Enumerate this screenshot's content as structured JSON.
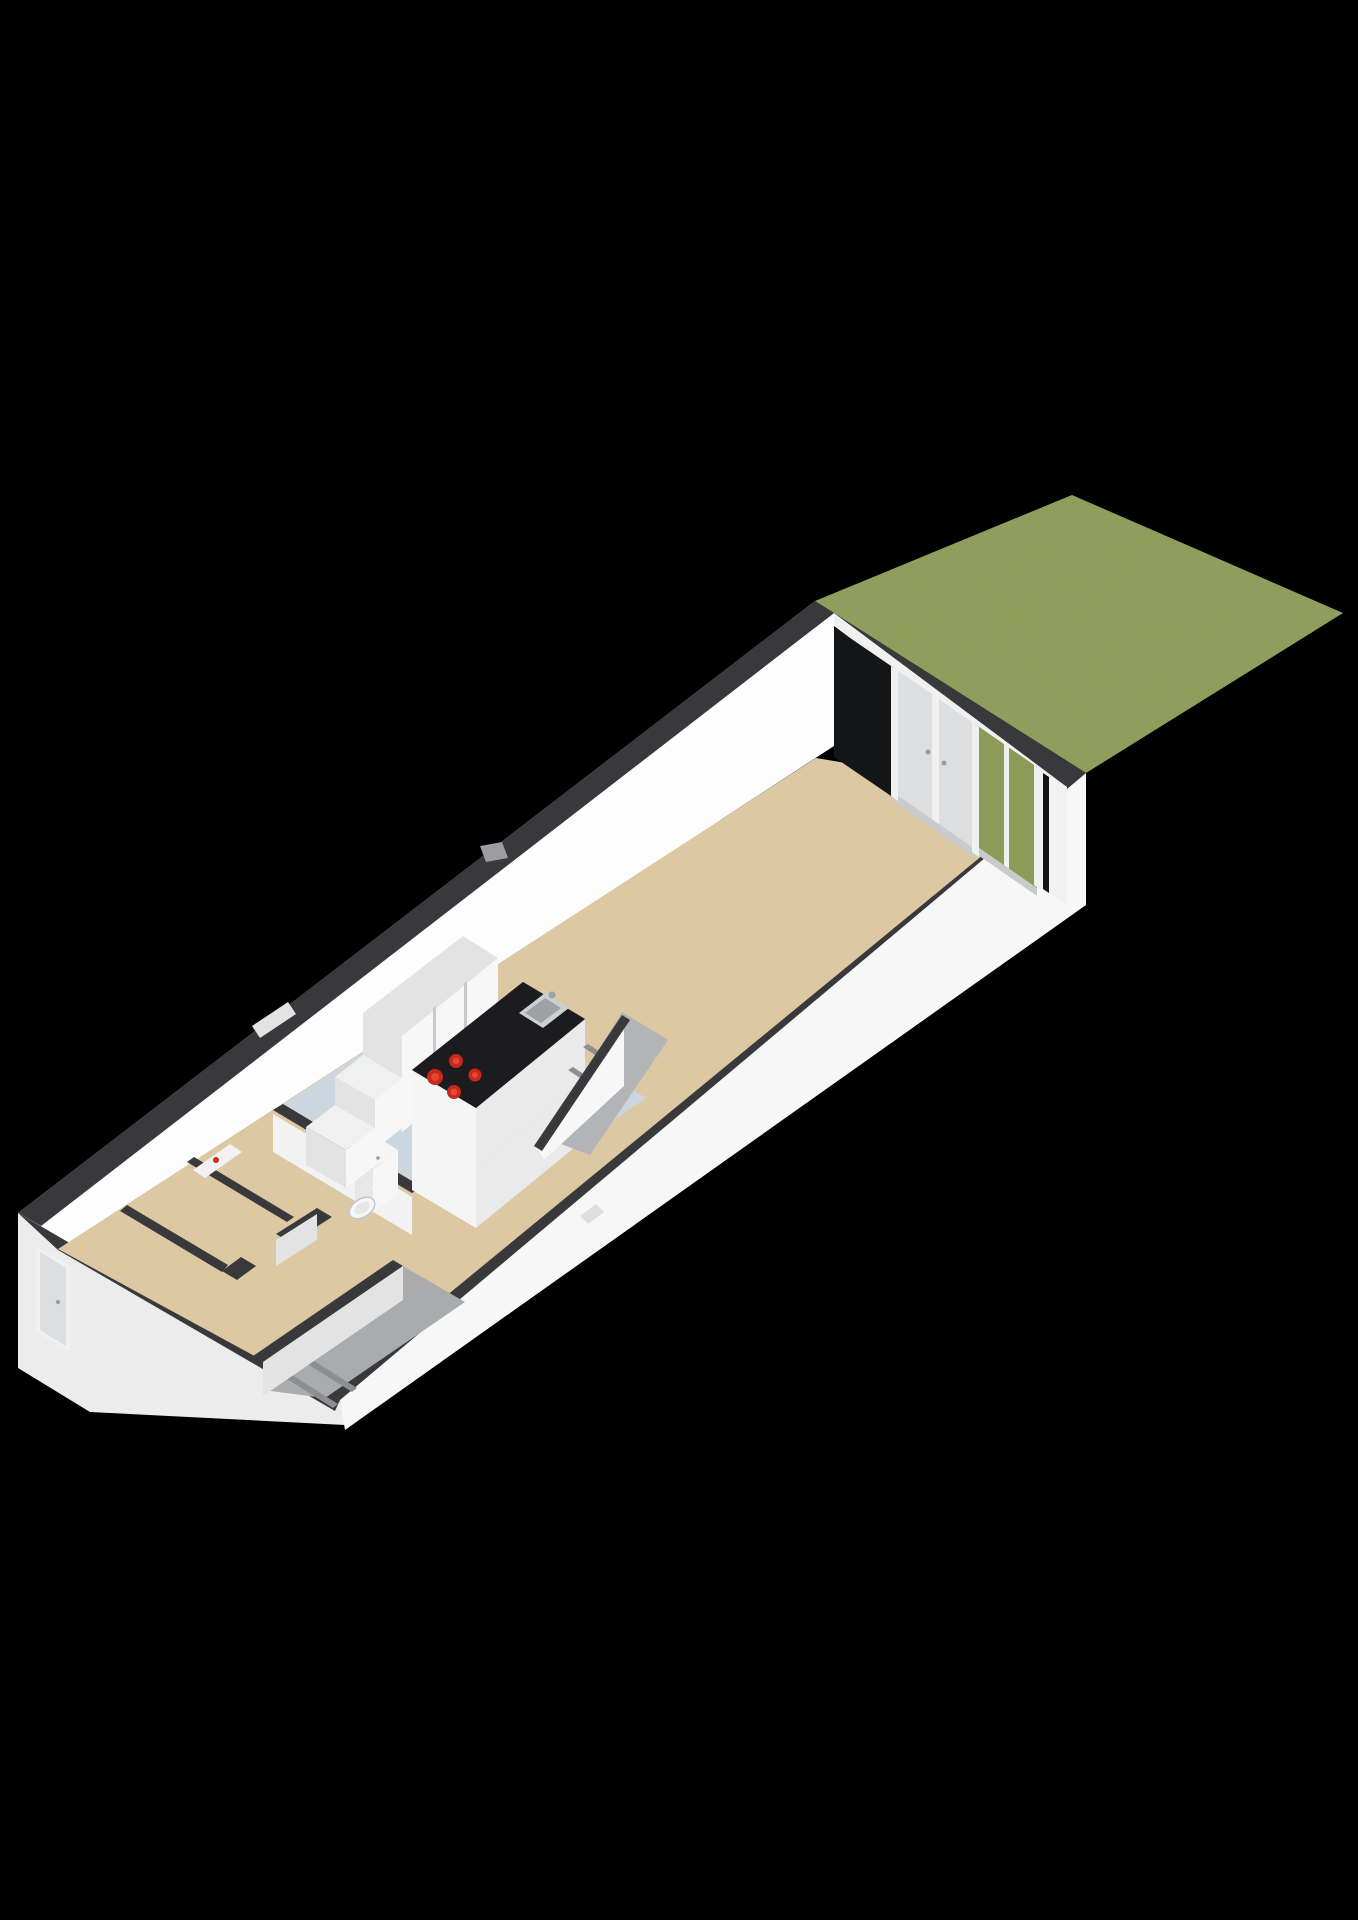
{
  "scene": {
    "type": "3d-floorplan-render",
    "view": "isometric-cutaway",
    "rooms": [
      "garden",
      "living-room",
      "kitchen",
      "hallway",
      "meter-closet",
      "toilet",
      "entry-stairs",
      "stair-to-upper-floor"
    ],
    "fixtures": [
      "front-door",
      "back-french-doors",
      "kitchen-island",
      "cooktop",
      "sink",
      "tall-cabinets",
      "toilet-bowl",
      "boiler",
      "radiator"
    ]
  },
  "colors": {
    "background": "#000000",
    "grass": "#8d9b58",
    "grassDark": "#55622c",
    "capDark": "#39393b",
    "wallWhite": "#f2f2f2",
    "wallBright": "#fdfdfd",
    "wallLit": "#f7f7f7",
    "wallShaded": "#e3e3e3",
    "wallOuter": "#ececec",
    "floorBeige": "#dcc9a3",
    "floorKitchen": "#ccd6de",
    "stairGray": "#a9abad",
    "stairEdge": "#8c8e90",
    "stairTop": "#b2b4b6",
    "islandTop": "#1c1c1e",
    "islandFront": "#f5f5f5",
    "islandSide": "#eaeaea",
    "burner": "#c5281c",
    "burnerInner": "#e8442e",
    "steel": "#ccd0d2",
    "steelDark": "#9da1a3",
    "doorPanel": "#dcdee0",
    "frame": "#f0f0f0",
    "glassDark": "#131517",
    "sill": "#c8cacc",
    "fixture": "#f6f6f6",
    "fixtureShade": "#e7e7e9",
    "accentRed": "#cc2a1e",
    "metal": "#9b9da0"
  }
}
